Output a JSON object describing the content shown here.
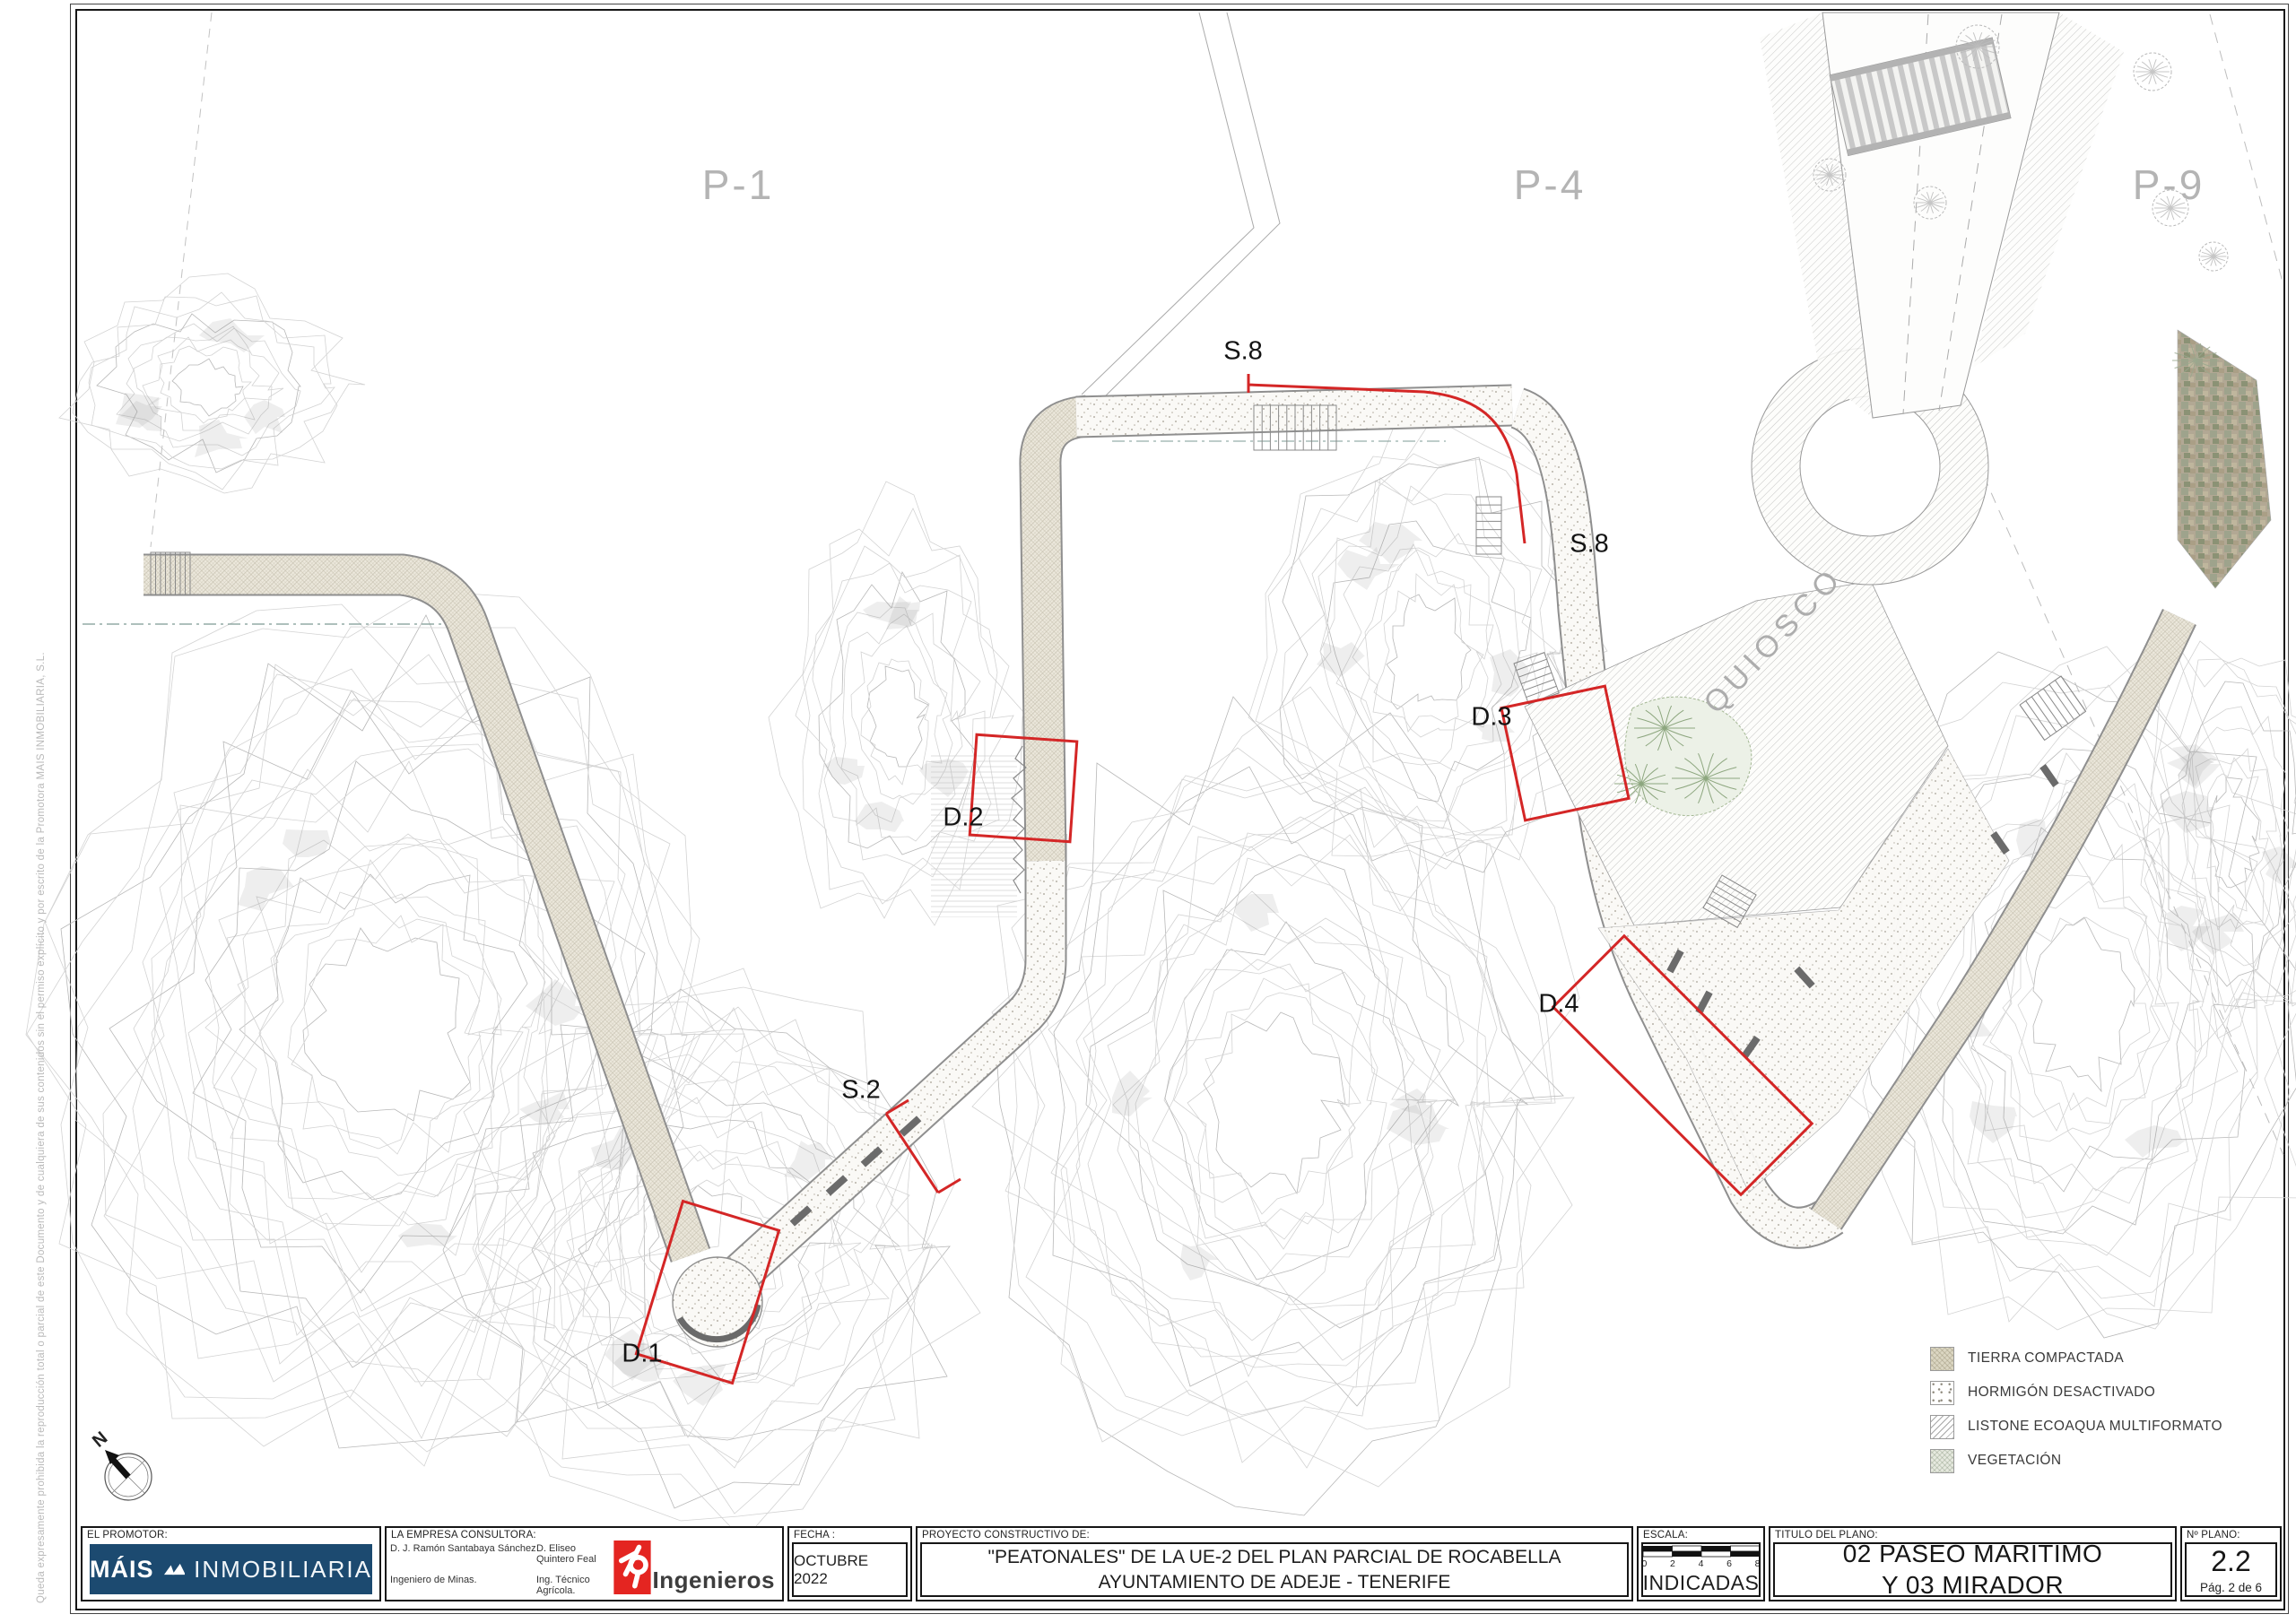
{
  "sheet": {
    "copyright_vertical": "Queda expresamente prohibida la reproducción total o parcial de este Documento y de cualquiera de sus contenidos sin el permiso explícito y por escrito de la Promotora MAIS INMOBILIARIA, S.L.",
    "colors": {
      "annotation_red": "#d42626",
      "parcel_gray": "#b4b4b4",
      "mais_blue": "#1c4a70",
      "ingenieros_red": "#e42521"
    }
  },
  "plan": {
    "parcel_labels": [
      {
        "text": "P-1"
      },
      {
        "text": "P-4"
      },
      {
        "text": "P-9"
      }
    ],
    "area_labels": [
      {
        "text": "QUIOSCO"
      }
    ],
    "section_markers": [
      {
        "text": "S.8"
      },
      {
        "text": "S.8"
      },
      {
        "text": "S.2"
      }
    ],
    "detail_markers": [
      {
        "text": "D.1"
      },
      {
        "text": "D.2"
      },
      {
        "text": "D.3"
      },
      {
        "text": "D.4"
      }
    ],
    "north_label": "N"
  },
  "legend": {
    "items": [
      {
        "label": "TIERRA COMPACTADA",
        "swatch": "tierra"
      },
      {
        "label": "HORMIGÓN DESACTIVADO",
        "swatch": "hormigon"
      },
      {
        "label": "LISTONE ECOAQUA MULTIFORMATO",
        "swatch": "listone"
      },
      {
        "label": "VEGETACIÓN",
        "swatch": "vegetacion"
      }
    ]
  },
  "titleblock": {
    "promotor": {
      "header": "EL PROMOTOR:",
      "brand_bold": "MÁIS",
      "brand_light": "INMOBILIARIA"
    },
    "consultora": {
      "header": "LA EMPRESA CONSULTORA:",
      "name1": "D. J. Ramón Santabaya Sánchez",
      "name2": "D. Eliseo Quintero Feal",
      "title1": "Ingeniero de Minas.",
      "title2": "Ing. Técnico Agrícola.",
      "firm": "Ingenieros"
    },
    "fecha": {
      "header": "FECHA :",
      "value": "OCTUBRE 2022"
    },
    "proyecto": {
      "header": "PROYECTO CONSTRUCTIVO DE:",
      "line1": "\"PEATONALES\" DE LA UE-2 DEL PLAN PARCIAL DE ROCABELLA",
      "line2": "AYUNTAMIENTO DE ADEJE - TENERIFE"
    },
    "escala": {
      "header": "ESCALA:",
      "value": "INDICADAS",
      "ticks": [
        "0",
        "2",
        "4",
        "6",
        "8"
      ]
    },
    "titulo": {
      "header": "TITULO DEL PLANO:",
      "line1": "02 PASEO MARÍTIMO",
      "line2": "Y 03 MIRADOR"
    },
    "nplano": {
      "header": "Nº PLANO:",
      "value": "2.2",
      "page": "Pág.  2  de 6"
    }
  }
}
